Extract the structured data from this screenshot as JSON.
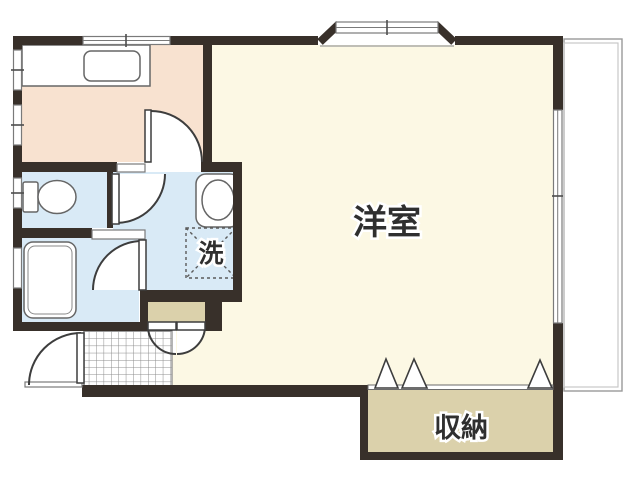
{
  "floorplan": {
    "rooms": {
      "western_room": {
        "label": "洋室"
      },
      "storage": {
        "label": "収納"
      },
      "laundry": {
        "label": "洗"
      }
    },
    "colors": {
      "wall": "#38302a",
      "kitchen": "#f8e2d0",
      "sanitary": "#d9eaf6",
      "room": "#fcf8e4",
      "storage": "#dbd1ab",
      "line": "#666666",
      "paper": "#ffffff",
      "text": "#2f2f2f"
    }
  }
}
